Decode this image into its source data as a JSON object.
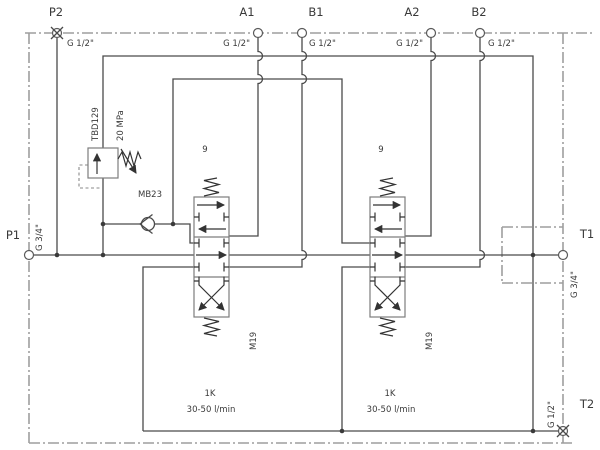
{
  "colors": {
    "line": "#4a4a4a",
    "border": "#9e9e9e",
    "background": "#ffffff"
  },
  "ports": {
    "p2": {
      "name": "P2",
      "thread": "G 1/2\"",
      "plugged": true
    },
    "a1": {
      "name": "A1",
      "thread": "G 1/2\"",
      "plugged": false
    },
    "b1": {
      "name": "B1",
      "thread": "G 1/2\"",
      "plugged": false
    },
    "a2": {
      "name": "A2",
      "thread": "G 1/2\"",
      "plugged": false
    },
    "b2": {
      "name": "B2",
      "thread": "G 1/2\"",
      "plugged": false
    },
    "p1": {
      "name": "P1",
      "thread": "G 3/4\"",
      "plugged": false
    },
    "t1": {
      "name": "T1",
      "thread": "G 3/4\"",
      "plugged": false
    },
    "t2": {
      "name": "T2",
      "thread": "G 1/2\"",
      "plugged": true
    }
  },
  "components": {
    "relief_valve": {
      "model": "TBD129",
      "setting": "20 MPa"
    },
    "check_valve": {
      "model": "MB23"
    },
    "spool1": {
      "id": "9",
      "spool_code": "M19"
    },
    "spool2": {
      "id": "9",
      "spool_code": "M19"
    },
    "section1": {
      "size": "1K",
      "flow": "30-50 l/min"
    },
    "section2": {
      "size": "1K",
      "flow": "30-50 l/min"
    }
  }
}
